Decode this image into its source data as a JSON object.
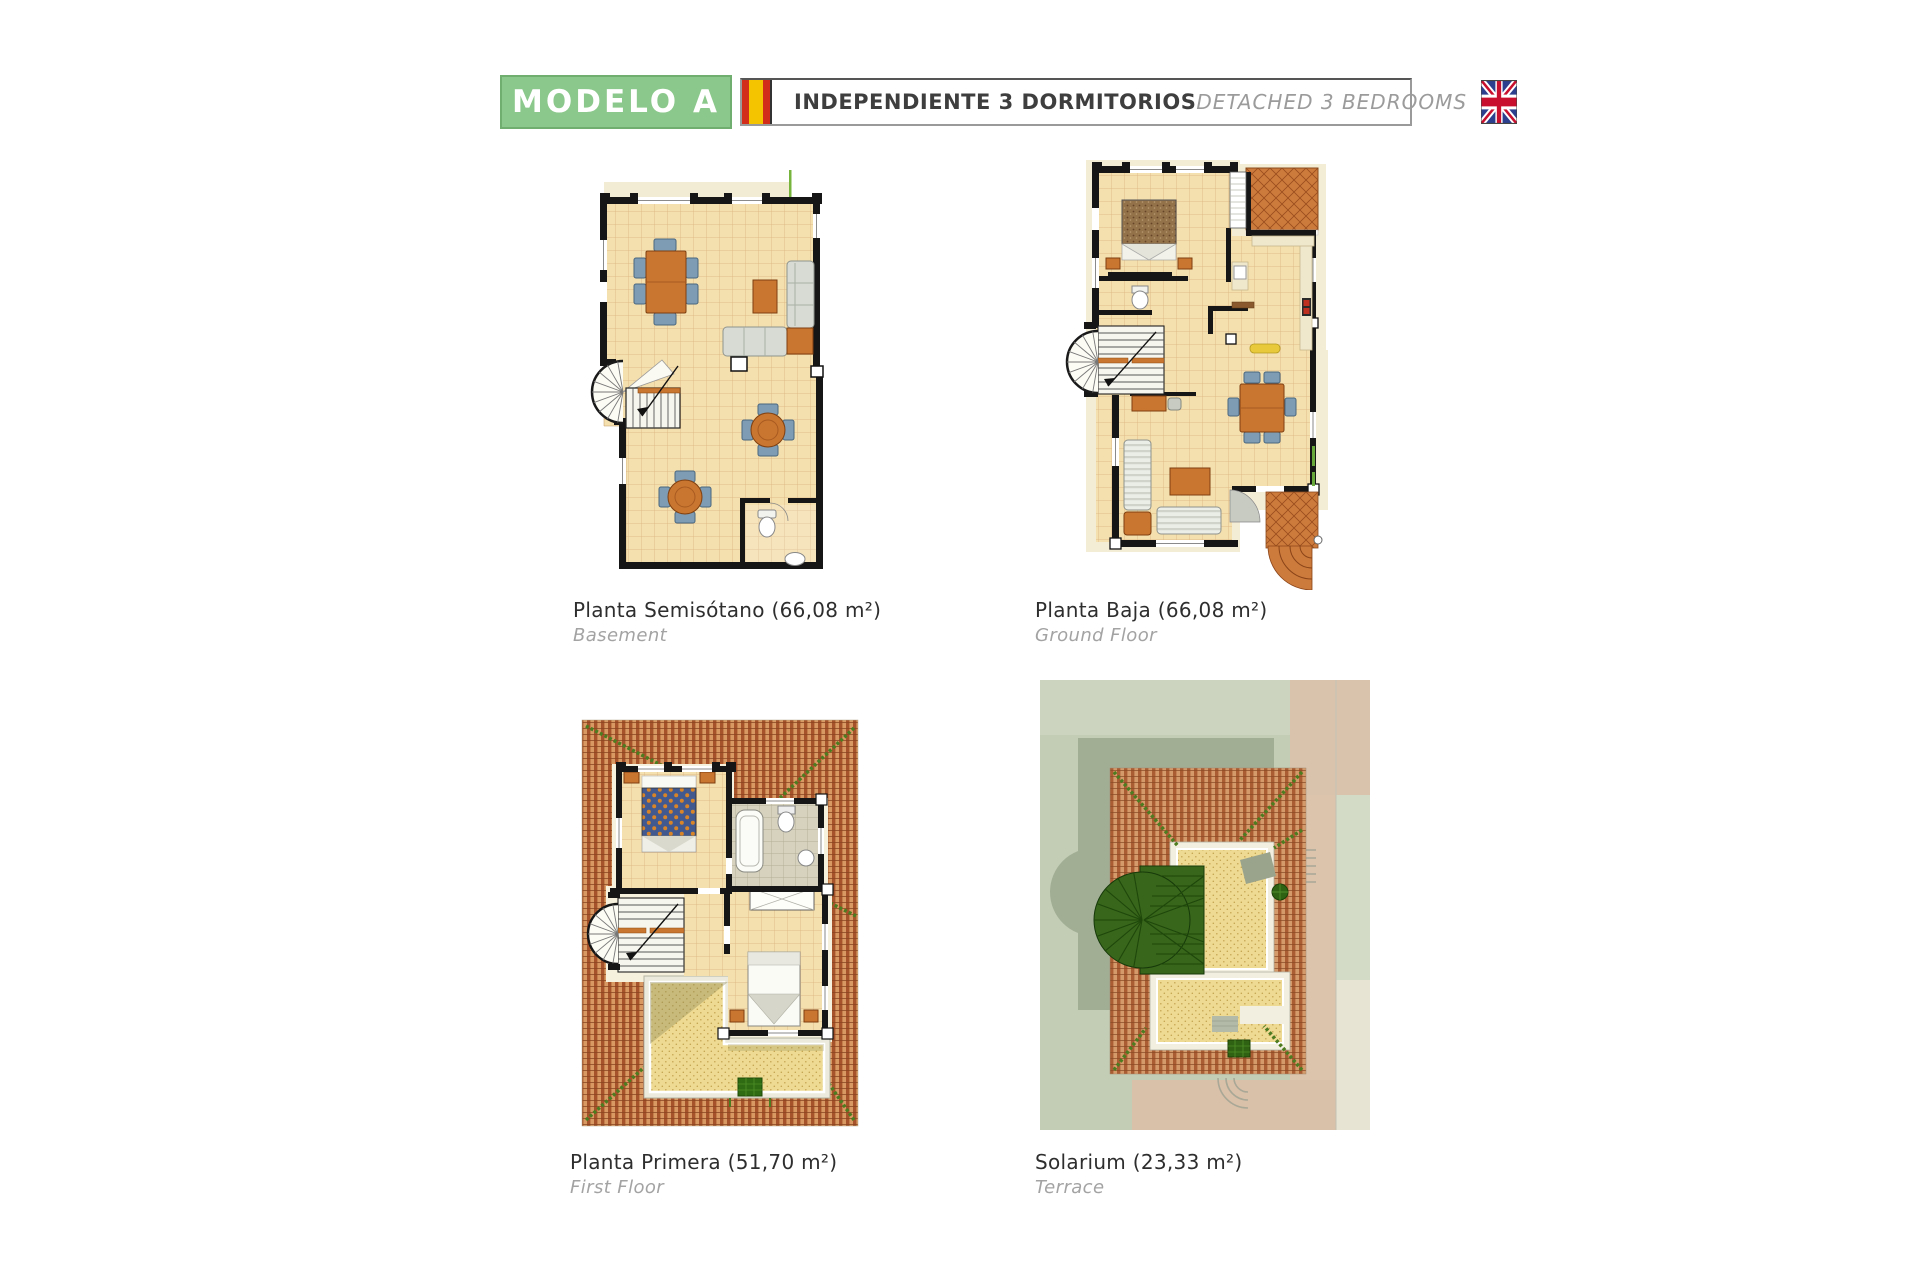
{
  "header": {
    "model_label": "MODELO A",
    "title_es": "INDEPENDIENTE 3 DORMITORIOS",
    "title_en": "DETACHED 3 BEDROOMS"
  },
  "plans": [
    {
      "title": "Planta Semisótano (66,08 m²)",
      "subtitle": "Basement"
    },
    {
      "title": "Planta Baja (66,08 m²)",
      "subtitle": "Ground Floor"
    },
    {
      "title": "Planta Primera (51,70 m²)",
      "subtitle": "First Floor"
    },
    {
      "title": "Solarium (23,33 m²)",
      "subtitle": "Terrace"
    }
  ],
  "icons": {
    "spain_flag": "spain-flag-icon",
    "uk_flag": "uk-flag-icon"
  },
  "colors": {
    "model_box_green": "#8bc88b",
    "title_text": "#3e3e3e",
    "title_en_text": "#9b9b9b",
    "floor_tile": "#f4dfae",
    "wall": "#161616",
    "furniture_orange": "#c97630",
    "chair_blue": "#7e9cb4",
    "roof_tile_dark": "#a6532b",
    "roof_tile_light": "#d89a62",
    "ridge_green": "#4d7c20",
    "solarium_sand": "#eeda92"
  }
}
